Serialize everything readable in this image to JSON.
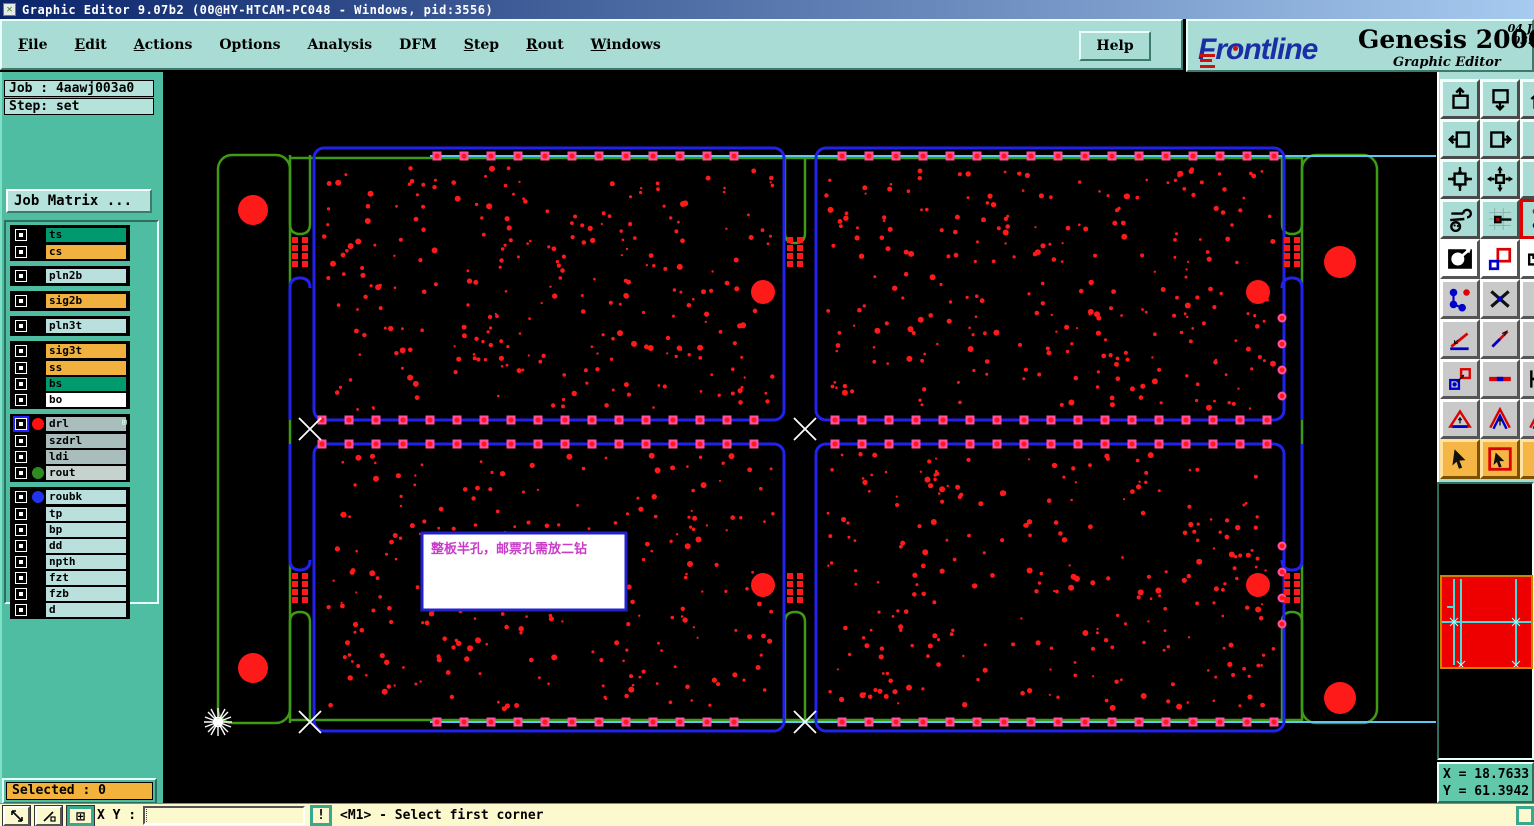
{
  "title_bar": {
    "title": "Graphic Editor 9.07b2 (00@HY-HTCAM-PC048 - Windows, pid:3556)",
    "icon_glyph": "✕"
  },
  "menu": {
    "items": [
      {
        "label": "File",
        "u": 0
      },
      {
        "label": "Edit",
        "u": 0
      },
      {
        "label": "Actions",
        "u": 0
      },
      {
        "label": "Options",
        "u": -1
      },
      {
        "label": "Analysis",
        "u": -1
      },
      {
        "label": "DFM",
        "u": -1
      },
      {
        "label": "Step",
        "u": 0
      },
      {
        "label": "Rout",
        "u": 0
      },
      {
        "label": "Windows",
        "u": 0
      }
    ],
    "help_label": "Help"
  },
  "brand": {
    "logo_text": "Frntline",
    "logo_left": "Fr",
    "logo_o": "o",
    "logo_right": "ntline",
    "product": "Genesis 2000",
    "subtitle": "Graphic Editor",
    "date_line": "04 J\n03:"
  },
  "sidebar": {
    "job_label": "Job : 4aawj003a0",
    "step_label": "Step: set",
    "job_matrix_label": "Job Matrix ...",
    "selected_label": "Selected : 0",
    "layer_groups": [
      {
        "rows": [
          {
            "name": "ts",
            "color": "#009a6e"
          },
          {
            "name": "cs",
            "color": "#f0b13e"
          }
        ]
      },
      {
        "rows": [
          {
            "name": "pln2b",
            "color": "#b9e0dc"
          }
        ]
      },
      {
        "rows": [
          {
            "name": "sig2b",
            "color": "#f0b13e"
          }
        ]
      },
      {
        "rows": [
          {
            "name": "pln3t",
            "color": "#b9e0dc"
          }
        ]
      },
      {
        "rows": [
          {
            "name": "sig3t",
            "color": "#f0b13e"
          },
          {
            "name": "ss",
            "color": "#f0b13e"
          },
          {
            "name": "bs",
            "color": "#009a6e"
          },
          {
            "name": "bo",
            "color": "#ffffff"
          }
        ]
      },
      {
        "rows": [
          {
            "name": "drl",
            "color": "#a9bdbd",
            "dot": "#ff1111",
            "selected": true,
            "grid_icon": "⊞"
          },
          {
            "name": "szdrl",
            "color": "#a9bdbd"
          },
          {
            "name": "ldi",
            "color": "#a9bdbd"
          },
          {
            "name": "rout",
            "color": "#c6d2ce",
            "dot": "#2e8b22"
          }
        ]
      },
      {
        "rows": [
          {
            "name": "roubk",
            "color": "#b9e0dc",
            "dot": "#2233ee"
          },
          {
            "name": "tp",
            "color": "#b9e0dc"
          },
          {
            "name": "bp",
            "color": "#b9e0dc"
          },
          {
            "name": "dd",
            "color": "#b9e0dc"
          },
          {
            "name": "npth",
            "color": "#b9e0dc"
          },
          {
            "name": "fzt",
            "color": "#b9e0dc"
          },
          {
            "name": "fzb",
            "color": "#b9e0dc"
          },
          {
            "name": "d",
            "color": "#b9e0dc"
          }
        ]
      }
    ]
  },
  "toolbar": {
    "rows": [
      {
        "style": "teal",
        "buttons": [
          "window-up",
          "window-down",
          "window-home"
        ]
      },
      {
        "style": "teal",
        "buttons": [
          "window-left",
          "window-right",
          "redraw"
        ]
      },
      {
        "style": "teal",
        "buttons": [
          "zoom-in-window",
          "zoom-fit",
          "zoom-one"
        ]
      },
      {
        "style": "teal",
        "buttons": [
          "setup-tools",
          "datum-point",
          "active-layer-tool"
        ]
      },
      {
        "style": "white",
        "buttons": [
          "invert-view",
          "transform-shapes",
          "measure-ruler"
        ]
      },
      {
        "style": "gray",
        "buttons": [
          "net-nodes",
          "delete-mark",
          "text-tool"
        ]
      },
      {
        "style": "gray",
        "buttons": [
          "measure-angle",
          "measure-slope",
          "measure-dot"
        ]
      },
      {
        "style": "gray",
        "buttons": [
          "copy-shape",
          "measure-width",
          "measure-edge"
        ]
      },
      {
        "style": "gray",
        "buttons": [
          "triangle-tool",
          "chevron-tool",
          "chevron-tool2"
        ]
      },
      {
        "style": "orange",
        "buttons": [
          "select-cursor",
          "select-window",
          "select-c"
        ]
      }
    ]
  },
  "canvas": {
    "annotation": "整板半孔，邮票孔需放二钻",
    "seed": 7,
    "pad_rows": [
      {
        "y": 84,
        "x0": 273,
        "x1": 1121,
        "step": 27,
        "skip": [
          596,
          662
        ]
      },
      {
        "y": 348,
        "x0": 158,
        "x1": 1121,
        "step": 27,
        "skip": [
          596,
          662
        ]
      },
      {
        "y": 372,
        "x0": 158,
        "x1": 1121,
        "step": 27,
        "skip": [
          596,
          662
        ]
      },
      {
        "y": 650,
        "x0": 273,
        "x1": 1121,
        "step": 27,
        "skip": [
          596,
          662
        ]
      }
    ],
    "pad_cols": [
      {
        "x": 1118,
        "ys": [
          246,
          272,
          298,
          324
        ]
      },
      {
        "x": 1118,
        "ys": [
          474,
          500,
          526,
          552
        ]
      }
    ],
    "stamp_cols": [
      {
        "xs": [
          131,
          141
        ],
        "ys": [
          168,
          176,
          184,
          192
        ]
      },
      {
        "xs": [
          626,
          636
        ],
        "ys": [
          168,
          176,
          184,
          192
        ]
      },
      {
        "xs": [
          1123,
          1133
        ],
        "ys": [
          168,
          176,
          184,
          192
        ]
      },
      {
        "xs": [
          131,
          141
        ],
        "ys": [
          504,
          512,
          520,
          528
        ]
      },
      {
        "xs": [
          626,
          636
        ],
        "ys": [
          504,
          512,
          520,
          528
        ]
      },
      {
        "xs": [
          1123,
          1133
        ],
        "ys": [
          504,
          512,
          520,
          528
        ]
      }
    ],
    "dot_regions": [
      {
        "x": 160,
        "y": 96,
        "w": 450,
        "h": 242,
        "n": 255
      },
      {
        "x": 662,
        "y": 96,
        "w": 448,
        "h": 242,
        "n": 255
      },
      {
        "x": 160,
        "y": 382,
        "w": 450,
        "h": 255,
        "n": 245
      },
      {
        "x": 662,
        "y": 382,
        "w": 448,
        "h": 255,
        "n": 245
      }
    ],
    "tooling_holes": [
      {
        "cx": 89,
        "cy": 138,
        "r": 15
      },
      {
        "cx": 89,
        "cy": 596,
        "r": 15
      },
      {
        "cx": 599,
        "cy": 220,
        "r": 12
      },
      {
        "cx": 1094,
        "cy": 220,
        "r": 12
      },
      {
        "cx": 599,
        "cy": 513,
        "r": 12
      },
      {
        "cx": 1094,
        "cy": 513,
        "r": 12
      },
      {
        "cx": 1176,
        "cy": 190,
        "r": 16
      },
      {
        "cx": 1176,
        "cy": 626,
        "r": 16
      }
    ],
    "x_markers": [
      {
        "x": 146,
        "y": 357
      },
      {
        "x": 641,
        "y": 357
      },
      {
        "x": 146,
        "y": 650
      },
      {
        "x": 641,
        "y": 650
      }
    ]
  },
  "coords": {
    "x_readout": "X = 18.7633",
    "y_readout": "Y = 61.3942"
  },
  "status_bar": {
    "xy_label": "X Y :",
    "input_value": "",
    "warn_label": "!",
    "message": "<M1> - Select first corner"
  },
  "colors": {
    "canvas_bg": "#000000",
    "green": "#3f9a14",
    "blue": "#2222ee",
    "cyan": "#5fc8f0",
    "red": "#ff1a1a",
    "pad_pink": "#ff50a0",
    "note_border": "#2222cc",
    "note_text": "#c83cc8",
    "teal_panel": "#a9dcd4",
    "sidebar_teal": "#4fbda1",
    "status_yellow": "#fcf9cf",
    "badge_orange": "#f2b23c",
    "title_a": "#0a246a",
    "title_b": "#a6caf0"
  }
}
